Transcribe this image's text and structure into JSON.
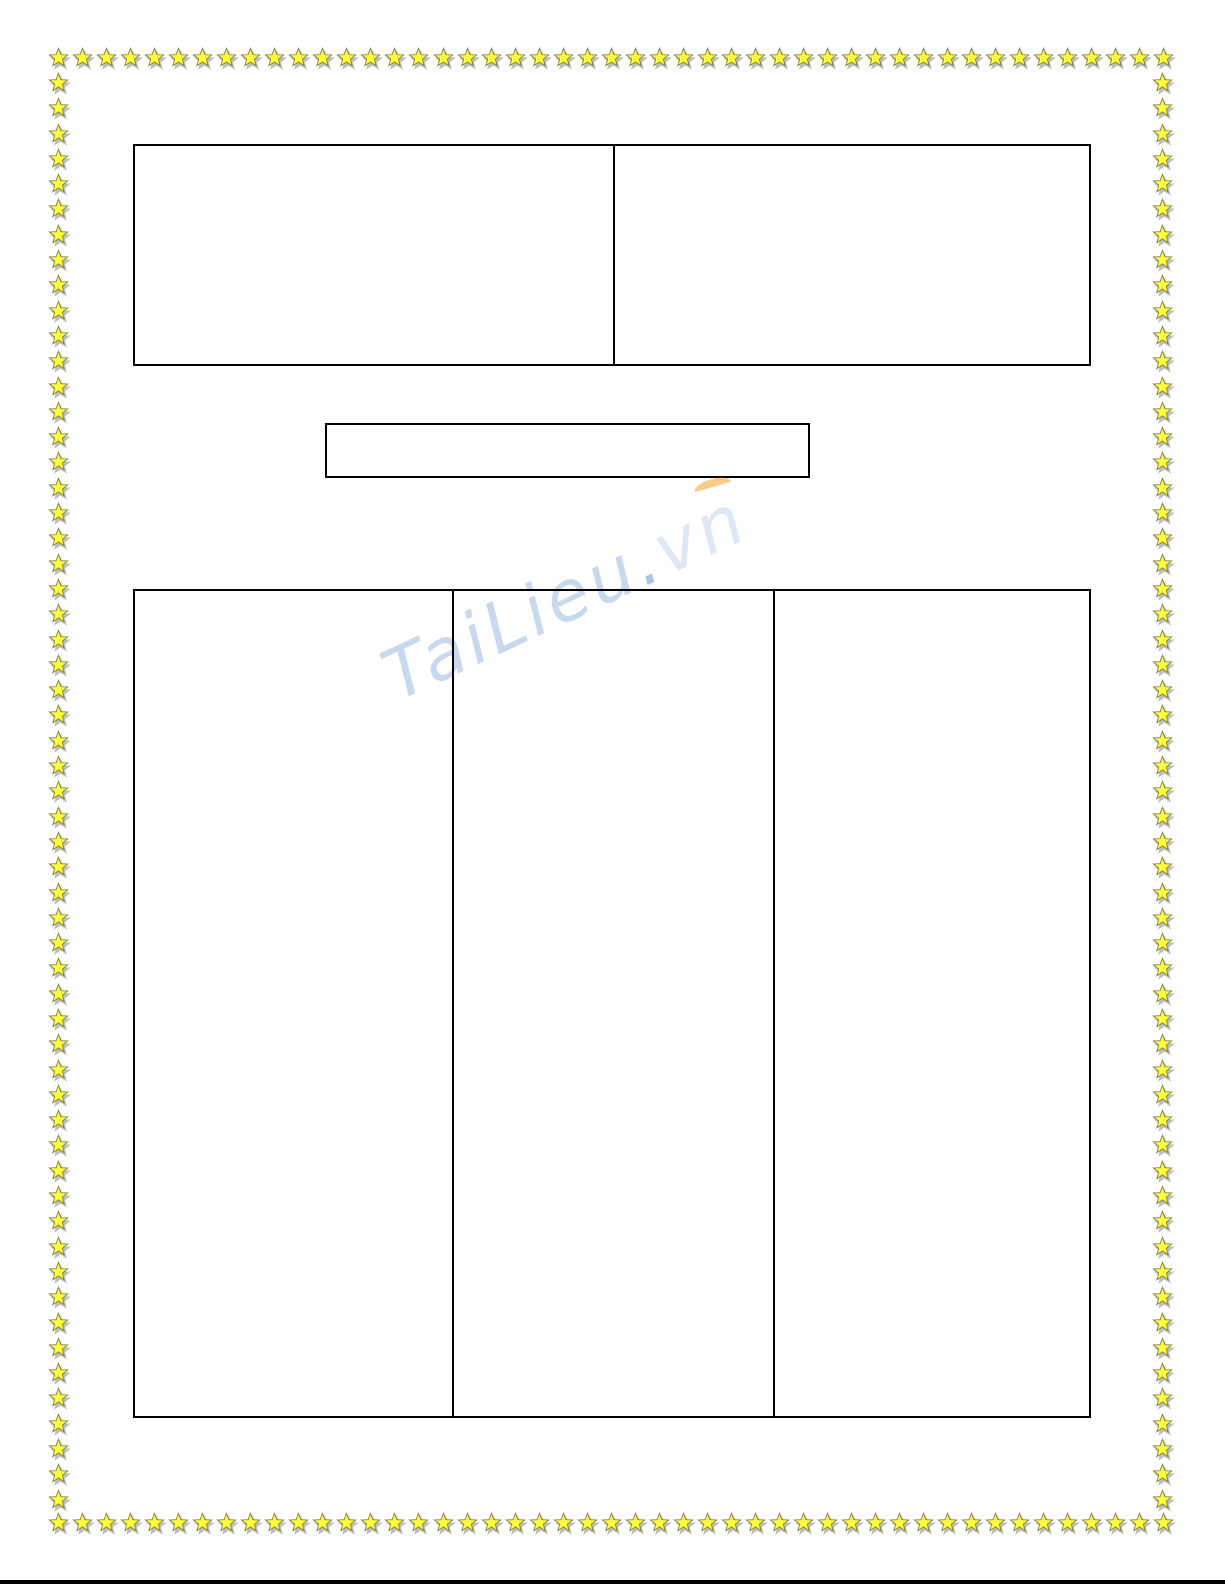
{
  "page": {
    "background": "#ffffff",
    "bottom_rule_color": "#000000"
  },
  "star_border": {
    "icon": "star-icon",
    "fill": "#ffff3d",
    "outline": "#7d7d46",
    "shadow": "#bdbdbd",
    "top_count": 47,
    "bottom_count": 47,
    "left_count": 57,
    "right_count": 57
  },
  "watermark": {
    "main": "TaiLieu",
    "dot": ".",
    "suffix": "vn",
    "main_color": "#c9d9ed",
    "dot_color": "#aec3e3",
    "suffix_color": "#dde7f5",
    "swoosh_color": "#f9cb88"
  },
  "header_table": {
    "cells": [
      "",
      ""
    ]
  },
  "title_box": {
    "value": ""
  },
  "main_table": {
    "cells": [
      "",
      "",
      ""
    ]
  }
}
